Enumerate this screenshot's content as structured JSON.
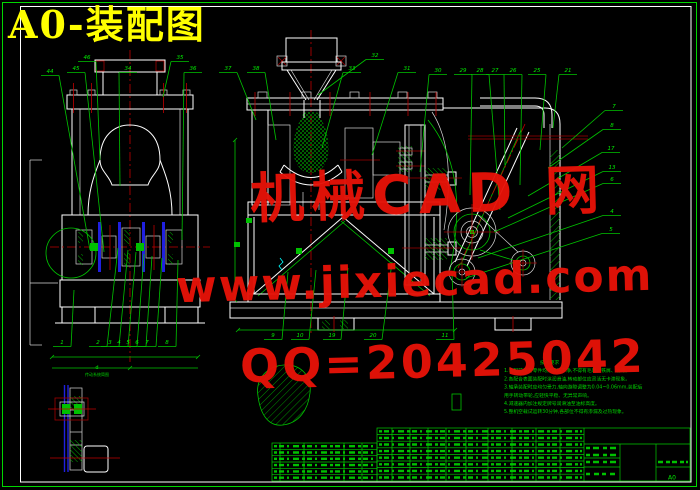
{
  "window": {
    "title": "A0-装配图"
  },
  "watermark": {
    "line1": "机械CAD 网",
    "line2": "www.jixiecad.com",
    "line3": "QQ=20425042",
    "color": "#e61208"
  },
  "colors": {
    "background": "#000000",
    "line_white": "#ffffff",
    "line_green": "#00cc00",
    "centerline_red": "#c00000",
    "highlight_blue": "#2020e0",
    "title_yellow": "#ffff00",
    "watermark_red": "#e61208"
  },
  "detail": {
    "letter": "d",
    "caption": "传动系统简图"
  },
  "notes": {
    "lines": [
      "技术要求",
      "1.装配前所有零件均需清洗干净,不得有毛刺、铁屑、油污。",
      "2.各配合表面装配时涂润滑油,转动部位应灵活无卡滞现象。",
      "3.轴承装配时应均匀受力,轴向游隙调整为0.04~0.06mm,装配后",
      "用手转动带轮,应轻快平稳、无异常声响。",
      "4.减速器内加注规定牌号润滑油至油标高度。",
      "5.整机空载试运转30分钟,各部位不得有渗漏及过热现象。"
    ]
  },
  "title_block": {
    "sheet_size": "A0"
  },
  "balloons": {
    "top": [
      {
        "n": "44",
        "x": 50,
        "y": 73,
        "tx": 90,
        "ty": 250
      },
      {
        "n": "45",
        "x": 76,
        "y": 70,
        "tx": 104,
        "ty": 252
      },
      {
        "n": "46",
        "x": 87,
        "y": 59,
        "tx": 100,
        "ty": 160
      },
      {
        "n": "34",
        "x": 128,
        "y": 70,
        "tx": 120,
        "ty": 186
      },
      {
        "n": "35",
        "x": 180,
        "y": 59,
        "tx": 163,
        "ty": 97
      },
      {
        "n": "36",
        "x": 193,
        "y": 70,
        "tx": 182,
        "ty": 240
      },
      {
        "n": "37",
        "x": 228,
        "y": 70,
        "tx": 256,
        "ty": 120
      },
      {
        "n": "38",
        "x": 256,
        "y": 70,
        "tx": 276,
        "ty": 140
      },
      {
        "n": "33",
        "x": 352,
        "y": 70,
        "tx": 322,
        "ty": 148
      },
      {
        "n": "32",
        "x": 375,
        "y": 57,
        "tx": 318,
        "ty": 95
      },
      {
        "n": "31",
        "x": 407,
        "y": 70,
        "tx": 372,
        "ty": 155
      },
      {
        "n": "30",
        "x": 438,
        "y": 72,
        "tx": 420,
        "ty": 172
      },
      {
        "n": "29",
        "x": 463,
        "y": 72,
        "tx": 470,
        "ty": 195
      },
      {
        "n": "28",
        "x": 480,
        "y": 72,
        "tx": 500,
        "ty": 210
      },
      {
        "n": "27",
        "x": 495,
        "y": 72,
        "tx": 505,
        "ty": 165
      },
      {
        "n": "26",
        "x": 513,
        "y": 72,
        "tx": 520,
        "ty": 185
      },
      {
        "n": "25",
        "x": 537,
        "y": 72,
        "tx": 540,
        "ty": 150
      },
      {
        "n": "21",
        "x": 568,
        "y": 72,
        "tx": 553,
        "ty": 128
      }
    ],
    "right": [
      {
        "n": "7",
        "x": 614,
        "y": 108,
        "tx": 562,
        "ty": 148
      },
      {
        "n": "8",
        "x": 612,
        "y": 127,
        "tx": 548,
        "ty": 168
      },
      {
        "n": "17",
        "x": 611,
        "y": 150,
        "tx": 528,
        "ty": 196
      },
      {
        "n": "13",
        "x": 612,
        "y": 169,
        "tx": 508,
        "ty": 218
      },
      {
        "n": "6",
        "x": 612,
        "y": 181,
        "tx": 494,
        "ty": 232
      },
      {
        "n": "4",
        "x": 612,
        "y": 213,
        "tx": 478,
        "ty": 258
      },
      {
        "n": "5",
        "x": 611,
        "y": 231,
        "tx": 466,
        "ty": 278
      }
    ],
    "bottom_left": [
      {
        "n": "1",
        "x": 62,
        "y": 344,
        "tx": 74,
        "ty": 290
      },
      {
        "n": "2",
        "x": 98,
        "y": 344,
        "tx": 118,
        "ty": 248
      },
      {
        "n": "3",
        "x": 110,
        "y": 344,
        "tx": 128,
        "ty": 250
      },
      {
        "n": "4",
        "x": 119,
        "y": 344,
        "tx": 136,
        "ty": 252
      },
      {
        "n": "5",
        "x": 128,
        "y": 344,
        "tx": 144,
        "ty": 254
      },
      {
        "n": "6",
        "x": 137,
        "y": 344,
        "tx": 152,
        "ty": 256
      },
      {
        "n": "7",
        "x": 147,
        "y": 344,
        "tx": 162,
        "ty": 258
      },
      {
        "n": "8",
        "x": 167,
        "y": 344,
        "tx": 178,
        "ty": 260
      }
    ],
    "bottom_center": [
      {
        "n": "9",
        "x": 273,
        "y": 337,
        "tx": 288,
        "ty": 272
      },
      {
        "n": "10",
        "x": 300,
        "y": 337,
        "tx": 316,
        "ty": 270
      },
      {
        "n": "19",
        "x": 332,
        "y": 337,
        "tx": 348,
        "ty": 268
      },
      {
        "n": "20",
        "x": 373,
        "y": 337,
        "tx": 392,
        "ty": 262
      },
      {
        "n": "11",
        "x": 445,
        "y": 337,
        "tx": 452,
        "ty": 272
      }
    ]
  }
}
